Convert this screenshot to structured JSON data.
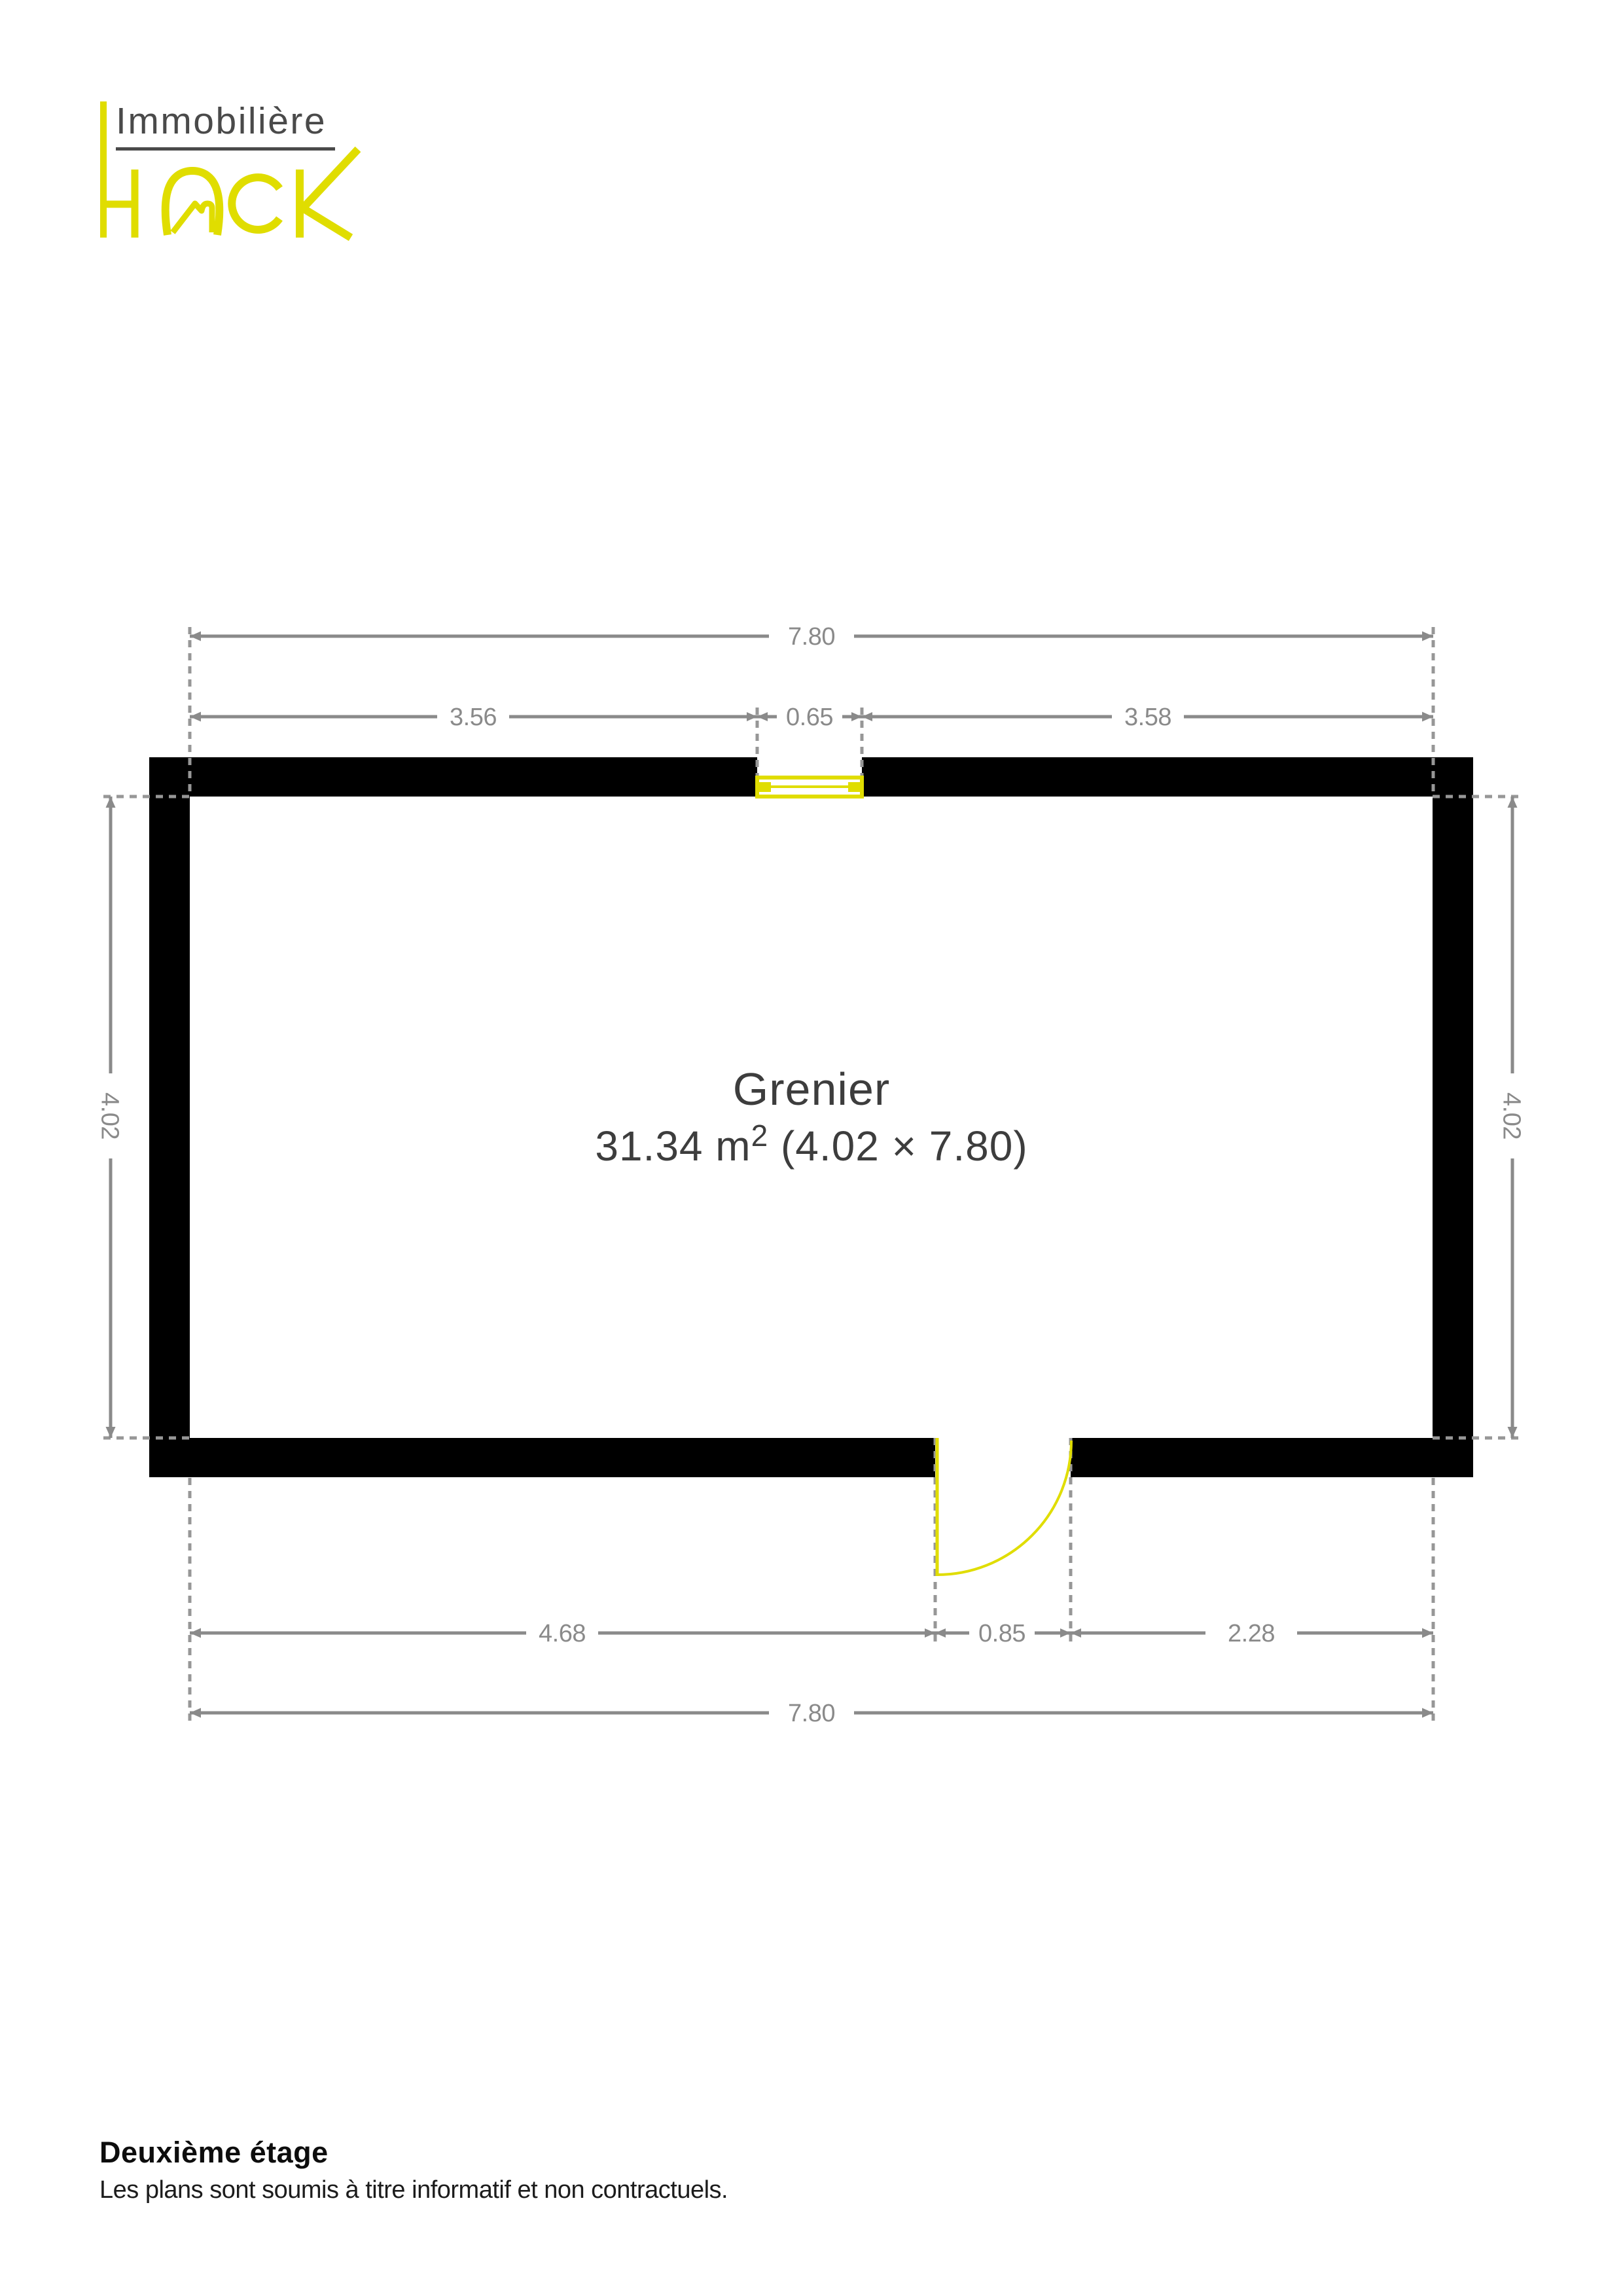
{
  "logo": {
    "line1": "Immobilière",
    "wordmark": "HACK",
    "accent_color": "#e0dd00",
    "text_color": "#4a4a4a"
  },
  "plan": {
    "room": {
      "name": "Grenier",
      "area_value": "31.34 m",
      "area_sup": "2",
      "area_dims": " (4.02 × 7.80)"
    },
    "dimensions": {
      "top_total": "7.80",
      "top_left": "3.56",
      "top_window": "0.65",
      "top_right": "3.58",
      "left_side": "4.02",
      "right_side": "4.02",
      "bottom_left": "4.68",
      "bottom_door": "0.85",
      "bottom_right": "2.28",
      "bottom_total": "7.80"
    },
    "colors": {
      "wall": "#000000",
      "dimension_gray": "#8a8a8a",
      "opening_yellow": "#e0dd00",
      "room_label_gray": "#3d3d3d"
    }
  },
  "footer": {
    "title": "Deuxième étage",
    "disclaimer": "Les plans sont soumis à titre informatif et non contractuels."
  }
}
